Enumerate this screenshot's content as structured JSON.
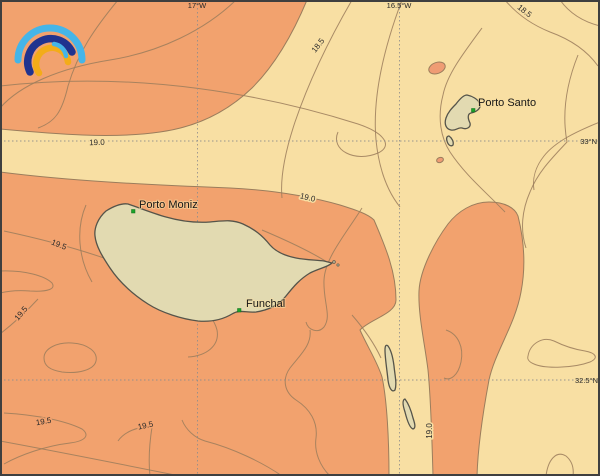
{
  "palette": {
    "sea_warm": "#f2a26e",
    "sea_cool": "#f8dfa3",
    "warm_spot": "#ef9c74",
    "land": "#e2dab1",
    "coast": "#55544a",
    "contour_line": "#9b7d5c",
    "marker_green": "#1ba329",
    "grid": "#8c8c8c",
    "frame": "#3f3f3f",
    "logo_light_blue": "#45b5e8",
    "logo_dark_blue": "#20338f",
    "logo_yellow": "#f3ac19"
  },
  "axes": {
    "meridians": [
      {
        "label": "17°W"
      },
      {
        "label": "16.5°W"
      }
    ],
    "parallels": [
      {
        "label": "33°N"
      },
      {
        "label": "32.5°N"
      }
    ]
  },
  "places": [
    {
      "name": "Porto Moniz"
    },
    {
      "name": "Funchal"
    },
    {
      "name": "Porto Santo"
    }
  ],
  "contour_labels": [
    {
      "value": "18.5"
    },
    {
      "value": "18.5"
    },
    {
      "value": "19.0"
    },
    {
      "value": "19.0"
    },
    {
      "value": "19.0"
    },
    {
      "value": "19.5"
    },
    {
      "value": "19.5"
    },
    {
      "value": "19.5"
    },
    {
      "value": "19.5"
    }
  ]
}
